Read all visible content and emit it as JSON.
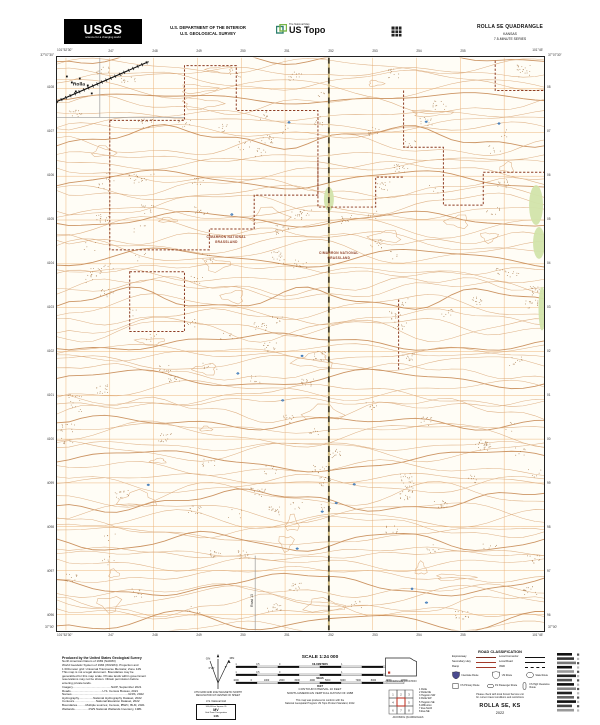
{
  "header": {
    "usgs": "USGS",
    "tagline": "science for a changing world",
    "dept1": "U.S. DEPARTMENT OF THE INTERIOR",
    "dept2": "U.S. GEOLOGICAL SURVEY",
    "tnm": "The National Map",
    "ustopo": "US Topo",
    "quad": "ROLLA SE QUADRANGLE",
    "state": "KANSAS",
    "series": "7.5-MINUTE SERIES"
  },
  "map": {
    "corners": {
      "tl_lon": "101°52'30\"",
      "tl_lat": "37°07'30\"",
      "tr_lon": "101°45'",
      "tr_lat": "37°07'30\"",
      "bl_lon": "101°52'30\"",
      "bl_lat": "37°00'",
      "br_lon": "101°45'",
      "br_lat": "37°00'"
    },
    "top_eastings": [
      "247",
      "248",
      "249",
      "250",
      "251",
      "252",
      "253",
      "254",
      "255"
    ],
    "bottom_eastings": [
      "247",
      "248",
      "249",
      "250",
      "251",
      "252",
      "253",
      "254",
      "255"
    ],
    "left_northings": [
      "4108",
      "4107",
      "4106",
      "4105",
      "4104",
      "4103",
      "4102",
      "4101",
      "4100",
      "4099",
      "4098",
      "4097",
      "4096"
    ],
    "right_northings": [
      "08",
      "07",
      "06",
      "05",
      "04",
      "03",
      "02",
      "01",
      "00",
      "99",
      "98",
      "97",
      "96"
    ],
    "labels": {
      "town": "Rolla",
      "grassland1": "CIMARRON NATIONAL",
      "grassland2": "GRASSLAND",
      "road": "Road 13"
    }
  },
  "footer": {
    "credits_title": "Produced by the United States Geological Survey",
    "credits": [
      "North American Datum of 1983 (NAD83)",
      "World Geodetic System of 1984 (WGS84). Projection and",
      "1 000-meter grid: Universal Transverse Mercator, Zone 14N",
      "This map is not a legal document. Boundaries may be",
      "generalized for this map scale. Private lands within government",
      "reservations may not be shown. Obtain permission before",
      "entering private lands."
    ],
    "sources": [
      "Imagery..............................................NAIP, September 2021",
      "Roads......................................U.S. Census Bureau, 2021",
      "Names....................................................................GNIS, 2022",
      "Hydrography.................National Hydrography Dataset, 2022",
      "Contours..........................National Elevation Dataset, 2022",
      "Boundaries..........Multiple sources; Census, IBWC, BLM, 2021",
      "Wetlands.................FWS National Wetlands Inventory, 1981"
    ],
    "declination": {
      "gn": "GN",
      "mn": "MN",
      "gn_angle": "0°29'",
      "mn_angle": "5°",
      "cap1": "UTM GRID AND 2022 MAGNETIC NORTH",
      "cap2": "DECLINATION AT CENTER OF SHEET"
    },
    "usng": {
      "title": "U.S. National Grid",
      "sq_label": "100,000-m Square ID",
      "sq_id": "MV",
      "gzd_label": "Grid Zone Designation",
      "gzd": "14S"
    },
    "scale": {
      "title": "SCALE 1:24 000",
      "km": "KILOMETERS",
      "mi": "MILES",
      "ft": "FEET",
      "km_ticks": [
        "1",
        "0.5",
        "0",
        "1",
        "2"
      ],
      "mi_ticks": [
        "1",
        "0.5",
        "0",
        "1"
      ],
      "ft_ticks": [
        "1000",
        "0",
        "1000",
        "2000",
        "3000",
        "4000",
        "5000",
        "6000",
        "7000",
        "8000",
        "9000",
        "10000"
      ],
      "ci1": "CONTOUR INTERVAL 10 FEET",
      "ci2": "NORTH AMERICAN VERTICAL DATUM OF 1988",
      "conform1": "This map was produced to conform with the",
      "conform2": "National Geospatial Program US Topo Product Standard, 2022."
    },
    "location": {
      "caption": "QUADRANGLE LOCATION",
      "adj_caption": "ADJOINING QUADRANGLES",
      "quads": [
        "Rolla",
        "Rolla NE",
        "Hugoton SW",
        "Rolla SW",
        "Hugoton SE",
        "Wilburton",
        "Eva North",
        "Eva NE"
      ]
    },
    "roadclass": {
      "title": "ROAD CLASSIFICATION",
      "rows": [
        {
          "l": "Expressway",
          "r": "Local Connector"
        },
        {
          "l": "Secondary Hwy",
          "r": "Local Road"
        },
        {
          "l": "Ramp",
          "r": "4WD"
        }
      ],
      "shields": [
        "Interstate Route",
        "US Route",
        "State Route"
      ],
      "fs": [
        "FS Primary Route",
        "FS Passenger Route",
        "FS High Clearance Route"
      ],
      "note1": "Please check with local Forest Service unit",
      "note2": "for current travel conditions and restrictions"
    },
    "sheet": {
      "name": "ROLLA SE, KS",
      "year": "2022"
    }
  },
  "colors": {
    "contour": "#dcab7c",
    "contour_index": "#c78a54",
    "grid": "#e59849",
    "boundary": "#8c3b22",
    "water": "#2e6fb5",
    "veg": "#d2e4ab",
    "road_fill": "#cdb97e",
    "grassland_text": "#8c3b22",
    "expressway_red": "#7c2b1e",
    "interstate_blue": "#4a4a8f"
  }
}
